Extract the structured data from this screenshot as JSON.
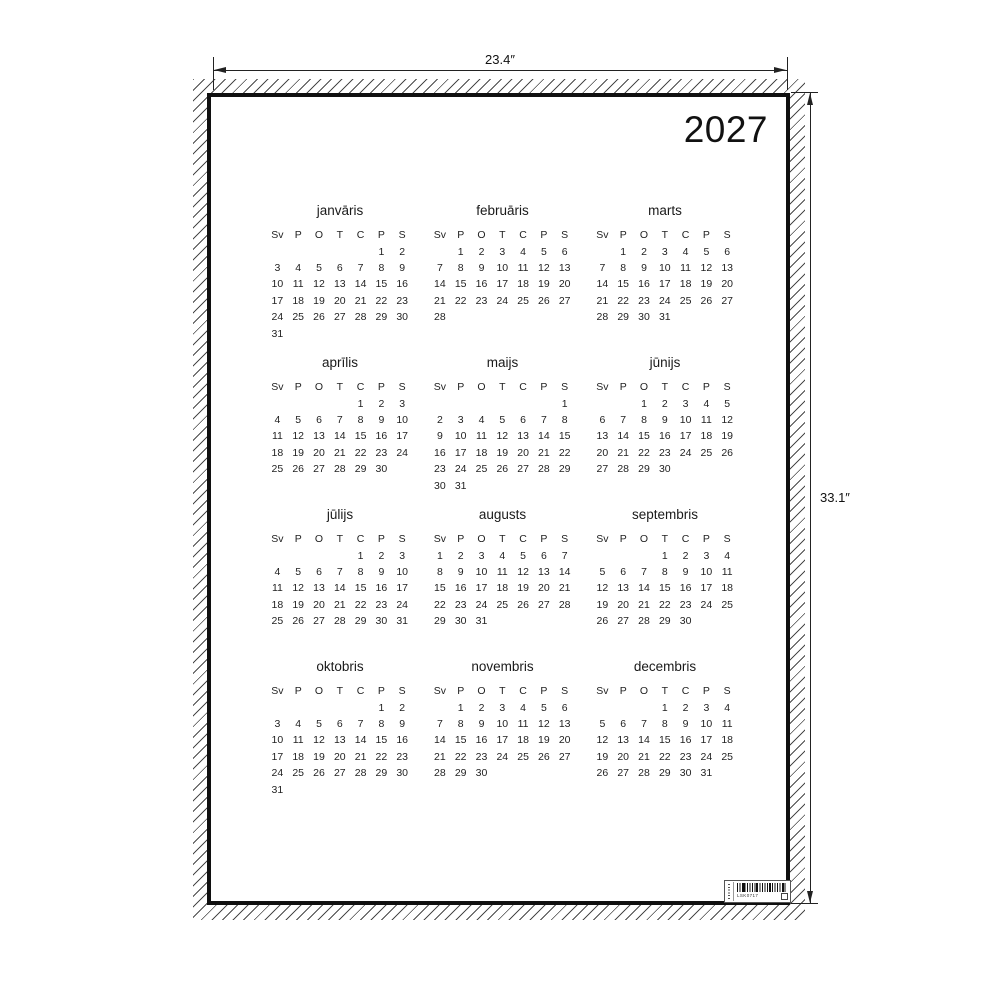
{
  "poster": {
    "year": "2027",
    "weekday_headers": [
      "Sv",
      "P",
      "O",
      "T",
      "C",
      "P",
      "S"
    ],
    "months": [
      {
        "name": "janvāris",
        "weeks": [
          [
            "",
            "",
            "",
            "",
            "",
            "1",
            "2"
          ],
          [
            "3",
            "4",
            "5",
            "6",
            "7",
            "8",
            "9"
          ],
          [
            "10",
            "11",
            "12",
            "13",
            "14",
            "15",
            "16"
          ],
          [
            "17",
            "18",
            "19",
            "20",
            "21",
            "22",
            "23"
          ],
          [
            "24",
            "25",
            "26",
            "27",
            "28",
            "29",
            "30"
          ],
          [
            "31",
            "",
            "",
            "",
            "",
            "",
            ""
          ]
        ]
      },
      {
        "name": "februāris",
        "weeks": [
          [
            "",
            "1",
            "2",
            "3",
            "4",
            "5",
            "6"
          ],
          [
            "7",
            "8",
            "9",
            "10",
            "11",
            "12",
            "13"
          ],
          [
            "14",
            "15",
            "16",
            "17",
            "18",
            "19",
            "20"
          ],
          [
            "21",
            "22",
            "23",
            "24",
            "25",
            "26",
            "27"
          ],
          [
            "28",
            "",
            "",
            "",
            "",
            "",
            ""
          ]
        ]
      },
      {
        "name": "marts",
        "weeks": [
          [
            "",
            "1",
            "2",
            "3",
            "4",
            "5",
            "6"
          ],
          [
            "7",
            "8",
            "9",
            "10",
            "11",
            "12",
            "13"
          ],
          [
            "14",
            "15",
            "16",
            "17",
            "18",
            "19",
            "20"
          ],
          [
            "21",
            "22",
            "23",
            "24",
            "25",
            "26",
            "27"
          ],
          [
            "28",
            "29",
            "30",
            "31",
            "",
            "",
            ""
          ]
        ]
      },
      {
        "name": "aprīlis",
        "weeks": [
          [
            "",
            "",
            "",
            "",
            "1",
            "2",
            "3"
          ],
          [
            "4",
            "5",
            "6",
            "7",
            "8",
            "9",
            "10"
          ],
          [
            "11",
            "12",
            "13",
            "14",
            "15",
            "16",
            "17"
          ],
          [
            "18",
            "19",
            "20",
            "21",
            "22",
            "23",
            "24"
          ],
          [
            "25",
            "26",
            "27",
            "28",
            "29",
            "30",
            ""
          ]
        ]
      },
      {
        "name": "maijs",
        "weeks": [
          [
            "",
            "",
            "",
            "",
            "",
            "",
            "1"
          ],
          [
            "2",
            "3",
            "4",
            "5",
            "6",
            "7",
            "8"
          ],
          [
            "9",
            "10",
            "11",
            "12",
            "13",
            "14",
            "15"
          ],
          [
            "16",
            "17",
            "18",
            "19",
            "20",
            "21",
            "22"
          ],
          [
            "23",
            "24",
            "25",
            "26",
            "27",
            "28",
            "29"
          ],
          [
            "30",
            "31",
            "",
            "",
            "",
            "",
            ""
          ]
        ]
      },
      {
        "name": "jūnijs",
        "weeks": [
          [
            "",
            "",
            "1",
            "2",
            "3",
            "4",
            "5"
          ],
          [
            "6",
            "7",
            "8",
            "9",
            "10",
            "11",
            "12"
          ],
          [
            "13",
            "14",
            "15",
            "16",
            "17",
            "18",
            "19"
          ],
          [
            "20",
            "21",
            "22",
            "23",
            "24",
            "25",
            "26"
          ],
          [
            "27",
            "28",
            "29",
            "30",
            "",
            "",
            ""
          ]
        ]
      },
      {
        "name": "jūlijs",
        "weeks": [
          [
            "",
            "",
            "",
            "",
            "1",
            "2",
            "3"
          ],
          [
            "4",
            "5",
            "6",
            "7",
            "8",
            "9",
            "10"
          ],
          [
            "11",
            "12",
            "13",
            "14",
            "15",
            "16",
            "17"
          ],
          [
            "18",
            "19",
            "20",
            "21",
            "22",
            "23",
            "24"
          ],
          [
            "25",
            "26",
            "27",
            "28",
            "29",
            "30",
            "31"
          ]
        ]
      },
      {
        "name": "augusts",
        "weeks": [
          [
            "1",
            "2",
            "3",
            "4",
            "5",
            "6",
            "7"
          ],
          [
            "8",
            "9",
            "10",
            "11",
            "12",
            "13",
            "14"
          ],
          [
            "15",
            "16",
            "17",
            "18",
            "19",
            "20",
            "21"
          ],
          [
            "22",
            "23",
            "24",
            "25",
            "26",
            "27",
            "28"
          ],
          [
            "29",
            "30",
            "31",
            "",
            "",
            "",
            ""
          ]
        ]
      },
      {
        "name": "septembris",
        "weeks": [
          [
            "",
            "",
            "",
            "1",
            "2",
            "3",
            "4"
          ],
          [
            "5",
            "6",
            "7",
            "8",
            "9",
            "10",
            "11"
          ],
          [
            "12",
            "13",
            "14",
            "15",
            "16",
            "17",
            "18"
          ],
          [
            "19",
            "20",
            "21",
            "22",
            "23",
            "24",
            "25"
          ],
          [
            "26",
            "27",
            "28",
            "29",
            "30",
            "",
            ""
          ]
        ]
      },
      {
        "name": "oktobris",
        "weeks": [
          [
            "",
            "",
            "",
            "",
            "",
            "1",
            "2"
          ],
          [
            "3",
            "4",
            "5",
            "6",
            "7",
            "8",
            "9"
          ],
          [
            "10",
            "11",
            "12",
            "13",
            "14",
            "15",
            "16"
          ],
          [
            "17",
            "18",
            "19",
            "20",
            "21",
            "22",
            "23"
          ],
          [
            "24",
            "25",
            "26",
            "27",
            "28",
            "29",
            "30"
          ],
          [
            "31",
            "",
            "",
            "",
            "",
            "",
            ""
          ]
        ]
      },
      {
        "name": "novembris",
        "weeks": [
          [
            "",
            "1",
            "2",
            "3",
            "4",
            "5",
            "6"
          ],
          [
            "7",
            "8",
            "9",
            "10",
            "11",
            "12",
            "13"
          ],
          [
            "14",
            "15",
            "16",
            "17",
            "18",
            "19",
            "20"
          ],
          [
            "21",
            "22",
            "23",
            "24",
            "25",
            "26",
            "27"
          ],
          [
            "28",
            "29",
            "30",
            "",
            "",
            "",
            ""
          ]
        ]
      },
      {
        "name": "decembris",
        "weeks": [
          [
            "",
            "",
            "",
            "1",
            "2",
            "3",
            "4"
          ],
          [
            "5",
            "6",
            "7",
            "8",
            "9",
            "10",
            "11"
          ],
          [
            "12",
            "13",
            "14",
            "15",
            "16",
            "17",
            "18"
          ],
          [
            "19",
            "20",
            "21",
            "22",
            "23",
            "24",
            "25"
          ],
          [
            "26",
            "27",
            "28",
            "29",
            "30",
            "31",
            ""
          ]
        ]
      }
    ],
    "barcode_code": "LSK0717"
  },
  "dimensions": {
    "width_label": "23.4″",
    "height_label": "33.1″"
  },
  "colors": {
    "ink": "#1a1a1a",
    "frame": "#101010",
    "dimension_line": "#222222",
    "background": "#ffffff"
  }
}
